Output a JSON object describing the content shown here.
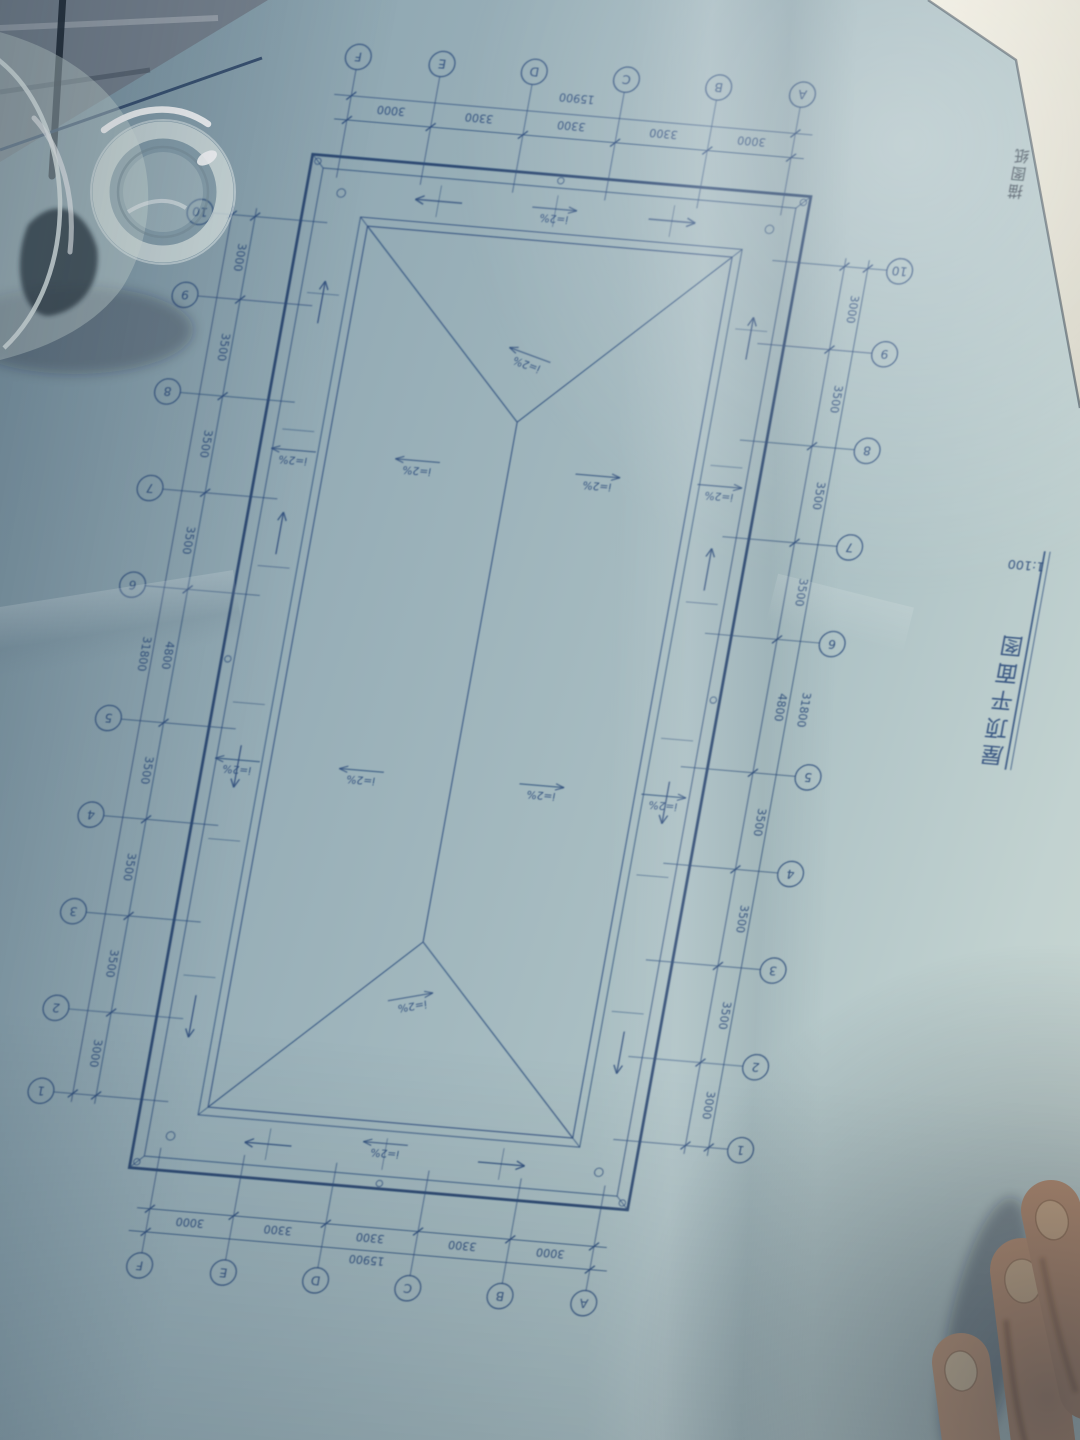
{
  "drawing": {
    "title": "屋顶平面图",
    "scale": "1:100",
    "stamp": "描图纸",
    "slope_label": "i=2%",
    "grids": {
      "letters": [
        "A",
        "B",
        "C",
        "D",
        "E",
        "F"
      ],
      "letter_spans": [
        "3000",
        "3300",
        "3300",
        "3300",
        "3000"
      ],
      "letter_total": "15900",
      "numbers": [
        "1",
        "2",
        "3",
        "4",
        "5",
        "6",
        "7",
        "8",
        "9",
        "10"
      ],
      "number_spans": [
        "3000",
        "3500",
        "3500",
        "3500",
        "4800",
        "3500",
        "3500",
        "3500",
        "3000"
      ],
      "number_total": "31800"
    },
    "colors": {
      "ink": "#2e4d7c",
      "ink_heavy": "#27456f",
      "paper": "#a7bcc2"
    }
  },
  "photo": {
    "objects": [
      "glass-cup",
      "hand-fingers",
      "white-paper-sheet",
      "blue-fabric"
    ]
  }
}
